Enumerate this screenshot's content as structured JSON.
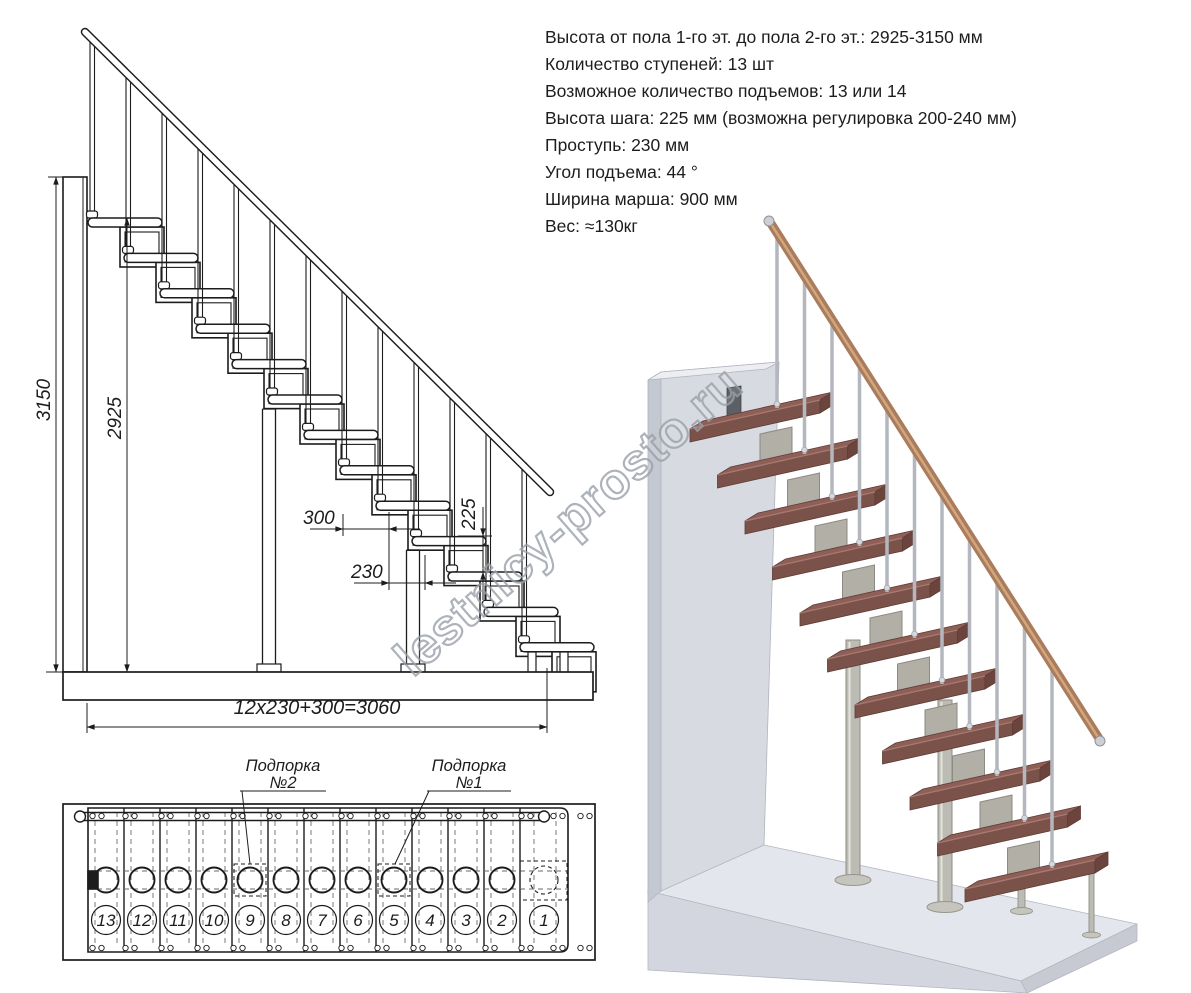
{
  "specs": {
    "lines": [
      "Высота от пола 1-го эт. до пола 2-го эт.: 2925-3150 мм",
      "Количество ступеней: 13 шт",
      "Возможное количество подъемов: 13 или 14",
      "Высота шага: 225 мм (возможна регулировка 200-240 мм)",
      "Проступь: 230 мм",
      "Угол подъема: 44 °",
      "Ширина марша: 900 мм",
      "Вес: ≈130кг"
    ]
  },
  "elevation": {
    "dim_total_height": "3150",
    "dim_floor_height": "2925",
    "dim_module_length": "300",
    "dim_tread_depth": "230",
    "dim_step_rise": "225",
    "dim_total_length": "12x230+300=3060"
  },
  "plan": {
    "support2_label": "Подпорка",
    "support2_no": "№2",
    "support1_label": "Подпорка",
    "support1_no": "№1",
    "step_numbers": [
      "13",
      "12",
      "11",
      "10",
      "9",
      "8",
      "7",
      "6",
      "5",
      "4",
      "3",
      "2",
      "1"
    ]
  },
  "watermark": {
    "text": "lestnicy-prosto.ru"
  },
  "colors": {
    "line": "#1c1c1c",
    "tread_wood": "#8f5f57",
    "handrail_copper": "#ad7f5f",
    "metal_post": "#b6b9bf",
    "wall_gray": "#d7dae1",
    "floor_gray": "#e4e6ed",
    "watermark_gray": "#9aa0a9"
  }
}
